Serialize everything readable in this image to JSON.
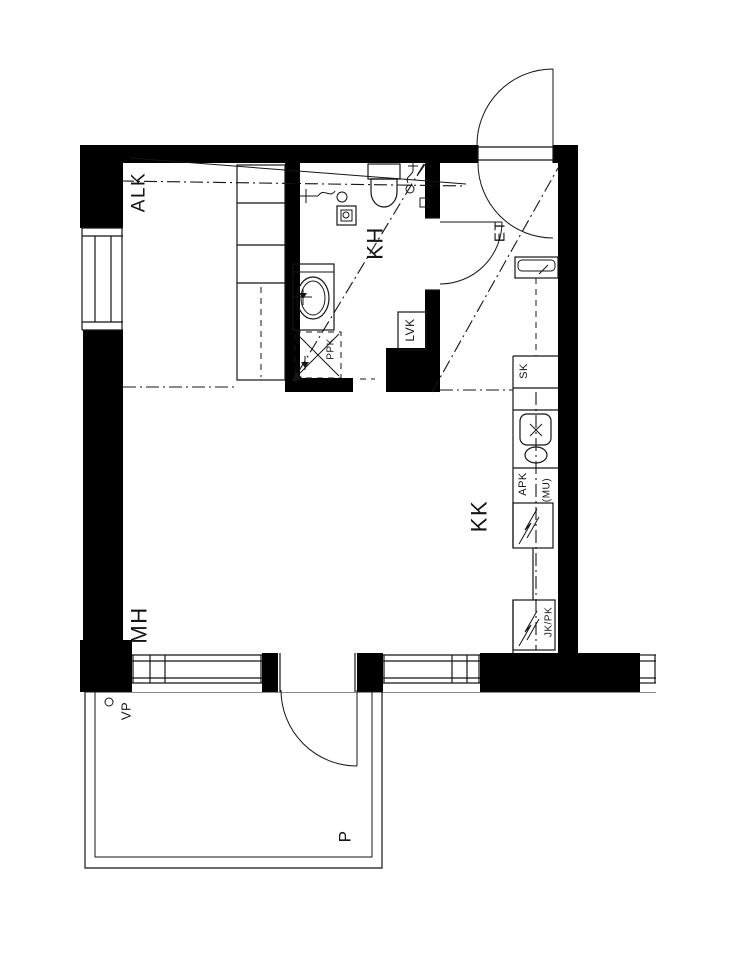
{
  "drawing": {
    "background": "#ffffff",
    "ink": "#141414",
    "wall_color": "#000000",
    "labels": {
      "alcove": "ALK",
      "bathroom": "KH",
      "entry": "ET",
      "kitchenette": "KK",
      "bedroom": "MH",
      "balcony": "P",
      "balcony_mark": "VP",
      "water_heater": "LVK",
      "cleaning_closet": "SK",
      "dishwasher": "APK",
      "dishwasher_alt": "(MU)",
      "fridge_freezer": "JK/PK",
      "washing_machine": "PPK"
    }
  }
}
